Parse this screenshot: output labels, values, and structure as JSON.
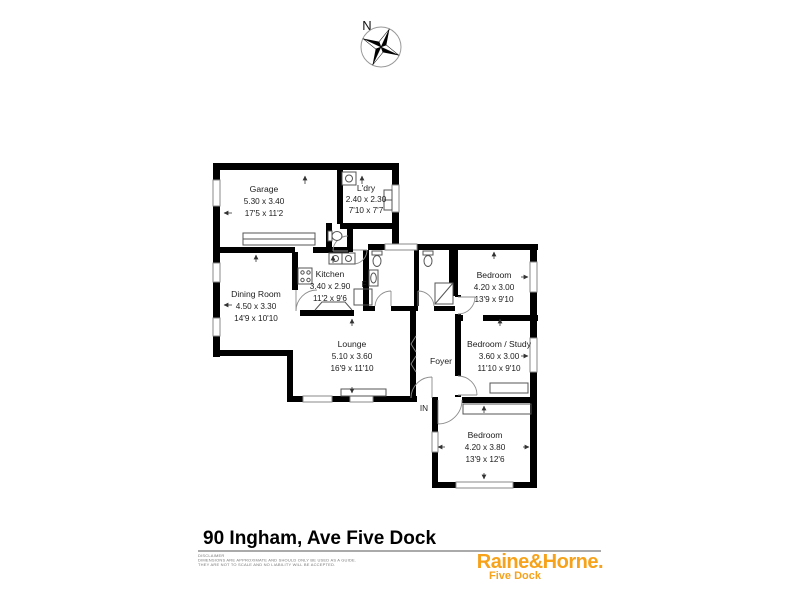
{
  "compass": {
    "label": "N"
  },
  "plan": {
    "entry_label": "IN",
    "fridge_label": "F",
    "rooms": [
      {
        "name": "Garage",
        "metric": "5.30 x 3.40",
        "imperial": "17'5 x 11'2"
      },
      {
        "name": "L'dry",
        "metric": "2.40 x 2.30",
        "imperial": "7'10 x 7'7"
      },
      {
        "name": "Kitchen",
        "metric": "3.40 x 2.90",
        "imperial": "11'2 x 9'6"
      },
      {
        "name": "Dining Room",
        "metric": "4.50 x 3.30",
        "imperial": "14'9 x 10'10"
      },
      {
        "name": "Bedroom",
        "metric": "4.20 x 3.00",
        "imperial": "13'9 x 9'10"
      },
      {
        "name": "Lounge",
        "metric": "5.10 x 3.60",
        "imperial": "16'9 x 11'10"
      },
      {
        "name": "Foyer",
        "metric": "",
        "imperial": ""
      },
      {
        "name": "Bedroom / Study",
        "metric": "3.60 x 3.00",
        "imperial": "11'10 x 9'10"
      },
      {
        "name": "Bedroom",
        "metric": "4.20 x 3.80",
        "imperial": "13'9 x 12'6"
      }
    ]
  },
  "footer": {
    "title": "90 Ingham, Ave Five Dock",
    "disclaimer": {
      "heading": "DISCLAIMER",
      "line1": "DIMENSIONS ARE APPROXIMATE AND SHOULD ONLY BE USED AS A GUIDE.",
      "line2": "THEY ARE NOT TO SCALE AND NO LIABILITY WILL BE ACCEPTED."
    },
    "brand": {
      "name": "Raine&Horne.",
      "office": "Five Dock",
      "color": "#F6A21A"
    }
  }
}
